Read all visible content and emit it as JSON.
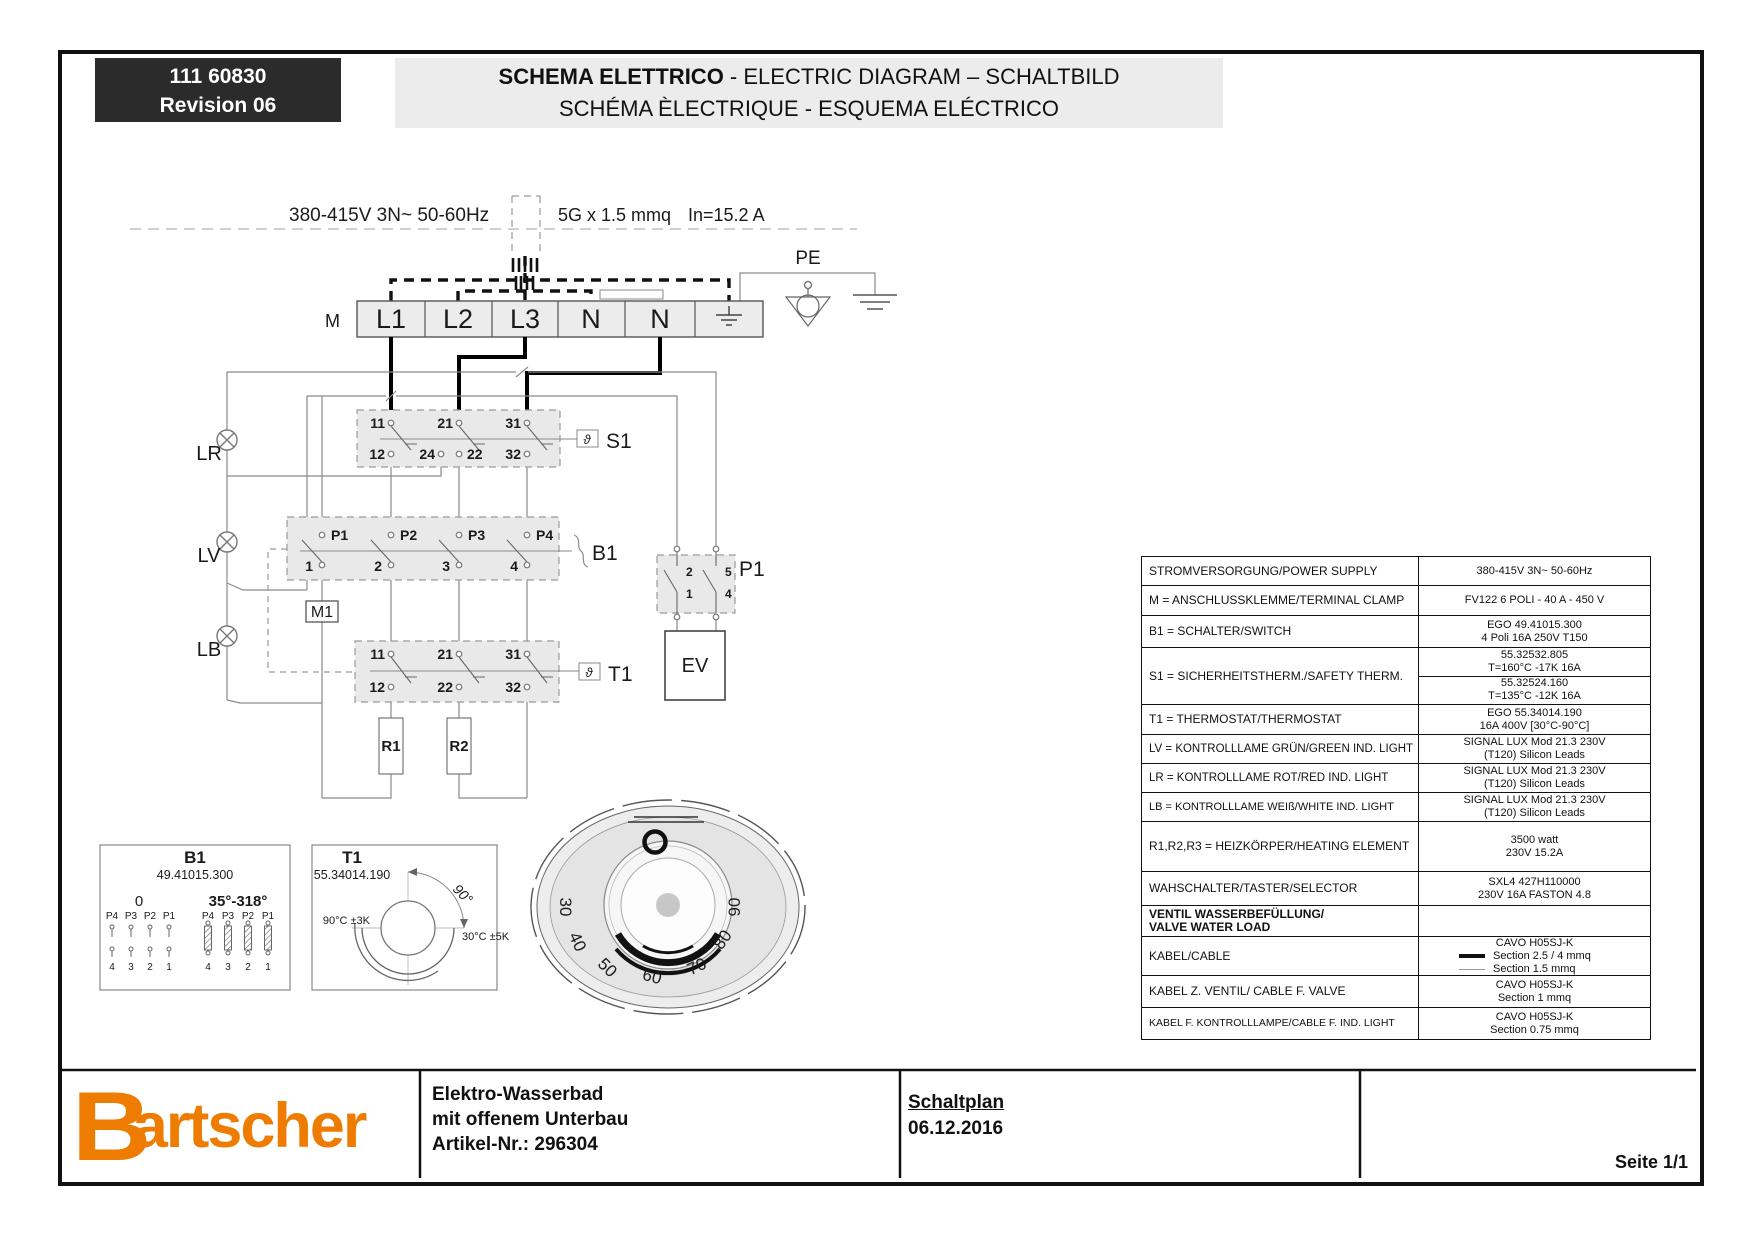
{
  "header": {
    "doc_number": "111 60830",
    "revision": "Revision 06",
    "title_bold": "SCHEMA ELETTRICO",
    "title_rest": " - ELECTRIC DIAGRAM – SCHALTBILD",
    "title_line2": "SCHÉMA ÈLECTRIQUE - ESQUEMA ELÉCTRICO"
  },
  "diagram": {
    "supply_label": "380-415V 3N~ 50-60Hz",
    "cable_spec": "5G x 1.5 mmq",
    "current": "In=15.2 A",
    "pe_label": "PE",
    "clamp_label": "M",
    "terminals": [
      "L1",
      "L2",
      "L3",
      "N",
      "N"
    ],
    "s1": {
      "label": "S1",
      "theta": "ϑ",
      "top": [
        "11",
        "21",
        "31"
      ],
      "bottom": [
        "12",
        "24",
        "22",
        "32"
      ]
    },
    "b1": {
      "label": "B1",
      "top": [
        "P1",
        "P2",
        "P3",
        "P4"
      ],
      "bottom": [
        "1",
        "2",
        "3",
        "4"
      ]
    },
    "t1": {
      "label": "T1",
      "theta": "ϑ",
      "top": [
        "11",
        "21",
        "31"
      ],
      "bottom": [
        "12",
        "22",
        "32"
      ]
    },
    "p1": {
      "label": "P1",
      "contacts": [
        "2",
        "1",
        "5",
        "4"
      ]
    },
    "m1": "M1",
    "ev": "EV",
    "r1": "R1",
    "r2": "R2",
    "lamps": [
      {
        "label": "LR"
      },
      {
        "label": "LV"
      },
      {
        "label": "LB"
      }
    ]
  },
  "b1_detail": {
    "title": "B1",
    "part": "49.41015.300",
    "pos_left": "0",
    "pos_right": "35°-318°",
    "pins_top": [
      "P4",
      "P3",
      "P2",
      "P1"
    ],
    "pins_bottom": [
      "4",
      "3",
      "2",
      "1"
    ]
  },
  "t1_detail": {
    "title": "T1",
    "part": "55.34014.190",
    "angle": "90°",
    "left_temp": "90°C ±3K",
    "right_temp": "30°C ±5K"
  },
  "knob": {
    "scale": [
      "30",
      "40",
      "50",
      "60",
      "70",
      "80",
      "90"
    ]
  },
  "table": {
    "rows": [
      {
        "label": "STROMVERSORGUNG/POWER SUPPLY",
        "values": [
          "380-415V 3N~ 50-60Hz"
        ]
      },
      {
        "label": "M = ANSCHLUSSKLEMME/TERMINAL CLAMP",
        "values": [
          "FV122 6 POLI - 40 A - 450 V"
        ]
      },
      {
        "label": "B1 = SCHALTER/SWITCH",
        "values": [
          "EGO 49.41015.300",
          "4 Poli 16A 250V T150"
        ]
      },
      {
        "label": "S1 = SICHERHEITSTHERM./SAFETY THERM.",
        "values_a": [
          "55.32532.805",
          "T=160°C -17K 16A"
        ],
        "values_b": [
          "55.32524.160",
          "T=135°C -12K 16A"
        ]
      },
      {
        "label": "T1 = THERMOSTAT/THERMOSTAT",
        "values": [
          "EGO 55.34014.190",
          "16A 400V [30°C-90°C]"
        ]
      },
      {
        "label": "LV = KONTROLLLAME GRÜN/GREEN IND. LIGHT",
        "values": [
          "SIGNAL LUX Mod 21.3 230V",
          "(T120) Silicon Leads"
        ]
      },
      {
        "label": "LR = KONTROLLLAME ROT/RED IND. LIGHT",
        "values": [
          "SIGNAL LUX Mod 21.3 230V",
          "(T120) Silicon Leads"
        ]
      },
      {
        "label": "LB = KONTROLLLAME WEIß/WHITE IND. LIGHT",
        "values": [
          "SIGNAL LUX Mod 21.3 230V",
          "(T120) Silicon Leads"
        ]
      },
      {
        "label": "R1,R2,R3 = HEIZKÖRPER/HEATING ELEMENT",
        "values": [
          "3500 watt",
          "230V 15.2A"
        ]
      },
      {
        "label": "WAHSCHALTER/TASTER/SELECTOR",
        "values": [
          "SXL4 427H110000",
          "230V 16A FASTON 4.8"
        ]
      },
      {
        "label_lines": [
          "VENTIL WASSERBEFÜLLUNG/",
          "VALVE WATER LOAD"
        ],
        "values": []
      },
      {
        "label": "KABEL/CABLE",
        "values": [
          "CAVO H05SJ-K"
        ],
        "samples": [
          {
            "text": "Section 2.5 / 4 mmq"
          },
          {
            "text": "Section 1.5 mmq"
          }
        ]
      },
      {
        "label": "KABEL Z. VENTIL/ CABLE F. VALVE",
        "values": [
          "CAVO H05SJ-K",
          "Section 1 mmq"
        ]
      },
      {
        "label": "KABEL F. KONTROLLLAMPE/CABLE F. IND. LIGHT",
        "values": [
          "CAVO H05SJ-K",
          "Section 0.75 mmq"
        ]
      }
    ]
  },
  "footer": {
    "brand_b": "B",
    "brand_rest": "artscher",
    "product_lines": [
      "Elektro-Wasserbad",
      "mit offenem Unterbau",
      "Artikel-Nr.: 296304"
    ],
    "plan": "Schaltplan",
    "date": "06.12.2016",
    "page": "Seite 1/1"
  },
  "colors": {
    "brand_orange": "#ee7c00",
    "box_fill": "#e9e9e9"
  }
}
